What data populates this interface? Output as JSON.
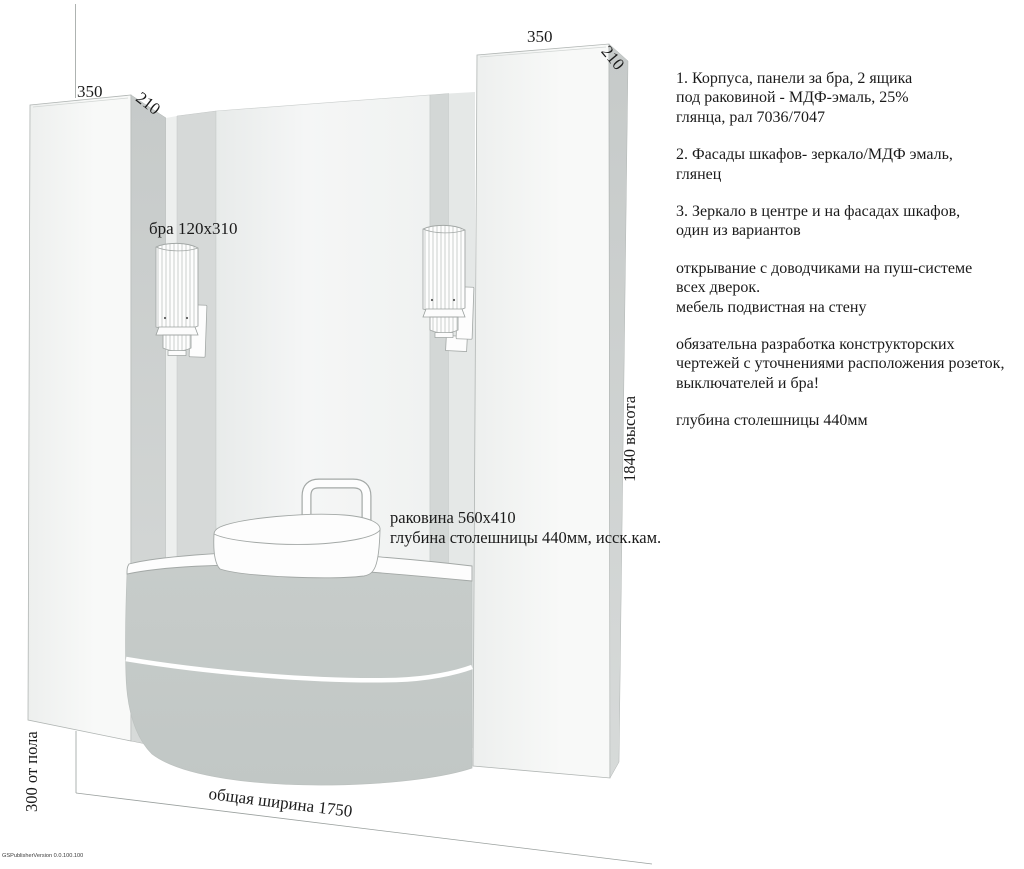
{
  "title_block": {
    "app_version": "GSPublisherVersion 0.0.100.100"
  },
  "dimensions": {
    "left_cab_width": "350",
    "left_cab_depth": "210",
    "right_cab_width": "350",
    "right_cab_depth": "210",
    "total_height": "1840 высота",
    "floor_offset": "300 от пола",
    "total_width": "общая ширина 1750"
  },
  "labels": {
    "sconce": "бра 120x310",
    "sink": "раковина 560x410\nглубина столешницы 440мм, исск.кам."
  },
  "notes": {
    "p1": "1. Корпуса, панели за бра, 2 ящика\nпод раковиной - МДФ-эмаль, 25%\nглянца, рал 7036/7047",
    "p2": "2. Фасады шкафов- зеркало/МДФ эмаль,\nглянец",
    "p3": "3. Зеркало в центре и на фасадах шкафов,\nодин из вариантов",
    "p4": "открывание с доводчиками на пуш-системе\nвсех дверок.\nмебель подвистная на стену",
    "p5": "обязательна разработка конструкторских\nчертежей с уточнениями расположения розеток,\nвыключателей и бра!",
    "p6": "глубина столешницы 440мм"
  },
  "colors": {
    "bg": "#ffffff",
    "ink": "#1a1a1a",
    "outline": "#b0b5b3",
    "thin-line": "#9aa09e",
    "metal-outline": "#a3a8a6",
    "panel-front-a": "#edefee",
    "panel-front-b": "#f8f9f8",
    "panel-side-a": "#c6cac9",
    "panel-side-b": "#d7dad9",
    "edge-strip": "#edefee",
    "sconce-strip": "#d6d9d8",
    "sconce-strip-right": "#d3d7d6",
    "strip-light": "#e5e8e7",
    "mirror-a": "#e8ebea",
    "mirror-b": "#f5f6f6",
    "mirror-c": "#f0f2f1",
    "vanity-a": "#c7ccca",
    "vanity-b": "#c1c7c5",
    "white": "#fdfdfd",
    "rib-line": "#c6cac8"
  }
}
